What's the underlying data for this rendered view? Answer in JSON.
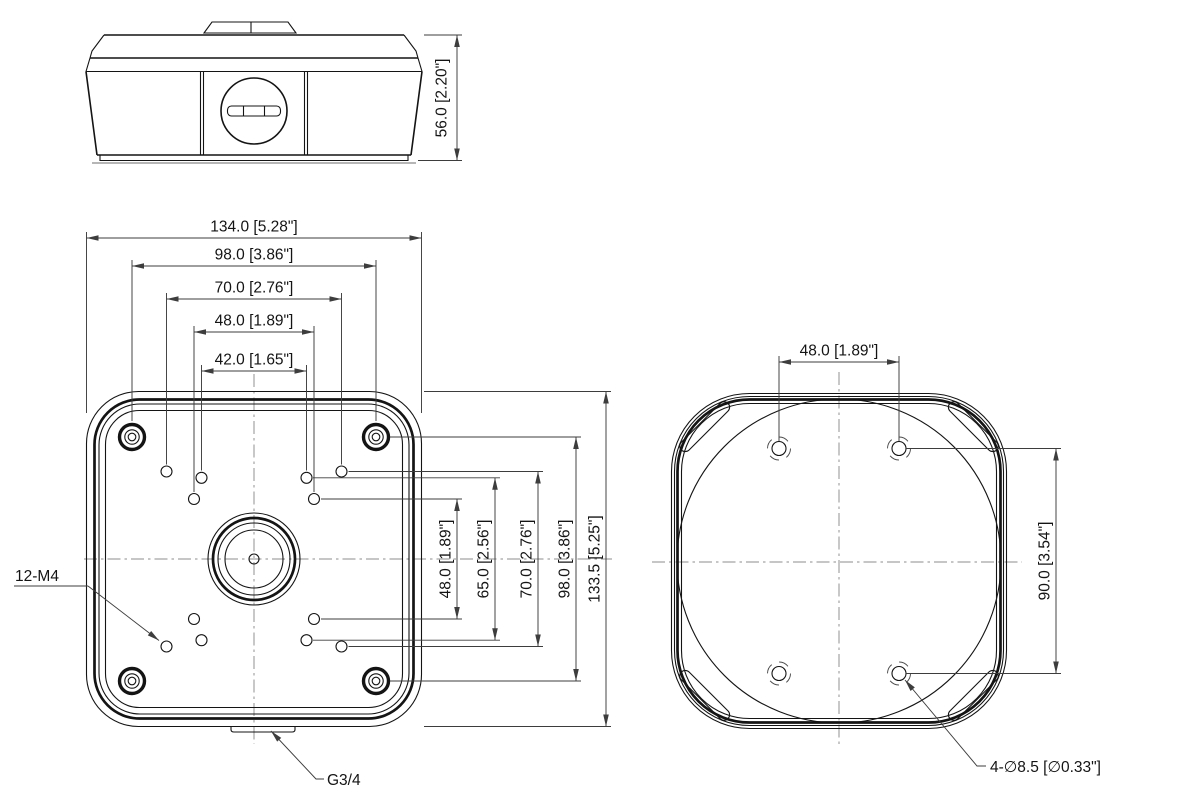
{
  "views": {
    "side": {
      "title": "side-view",
      "height_dim": "56.0 [2.20\"]"
    },
    "front": {
      "title": "front-view",
      "width_dims": [
        "134.0 [5.28\"]",
        "98.0 [3.86\"]",
        "70.0 [2.76\"]",
        "48.0 [1.89\"]",
        "42.0 [1.65\"]"
      ],
      "height_dims": [
        "48.0 [1.89\"]",
        "65.0 [2.56\"]",
        "70.0 [2.76\"]",
        "98.0 [3.86\"]",
        "133.5 [5.25\"]"
      ],
      "thread_holes_label": "12-M4",
      "conduit_thread_label": "G3/4"
    },
    "bottom": {
      "title": "bottom-view",
      "hole_spacing_horizontal": "48.0 [1.89\"]",
      "hole_spacing_vertical": "90.0 [3.54\"]",
      "mount_holes_label": "4-∅8.5 [∅0.33\"]"
    },
    "colors": {
      "outline": "#141414",
      "dimension": "#3d3d3d",
      "centerline": "#8c8c8c",
      "background": "#ffffff"
    }
  }
}
